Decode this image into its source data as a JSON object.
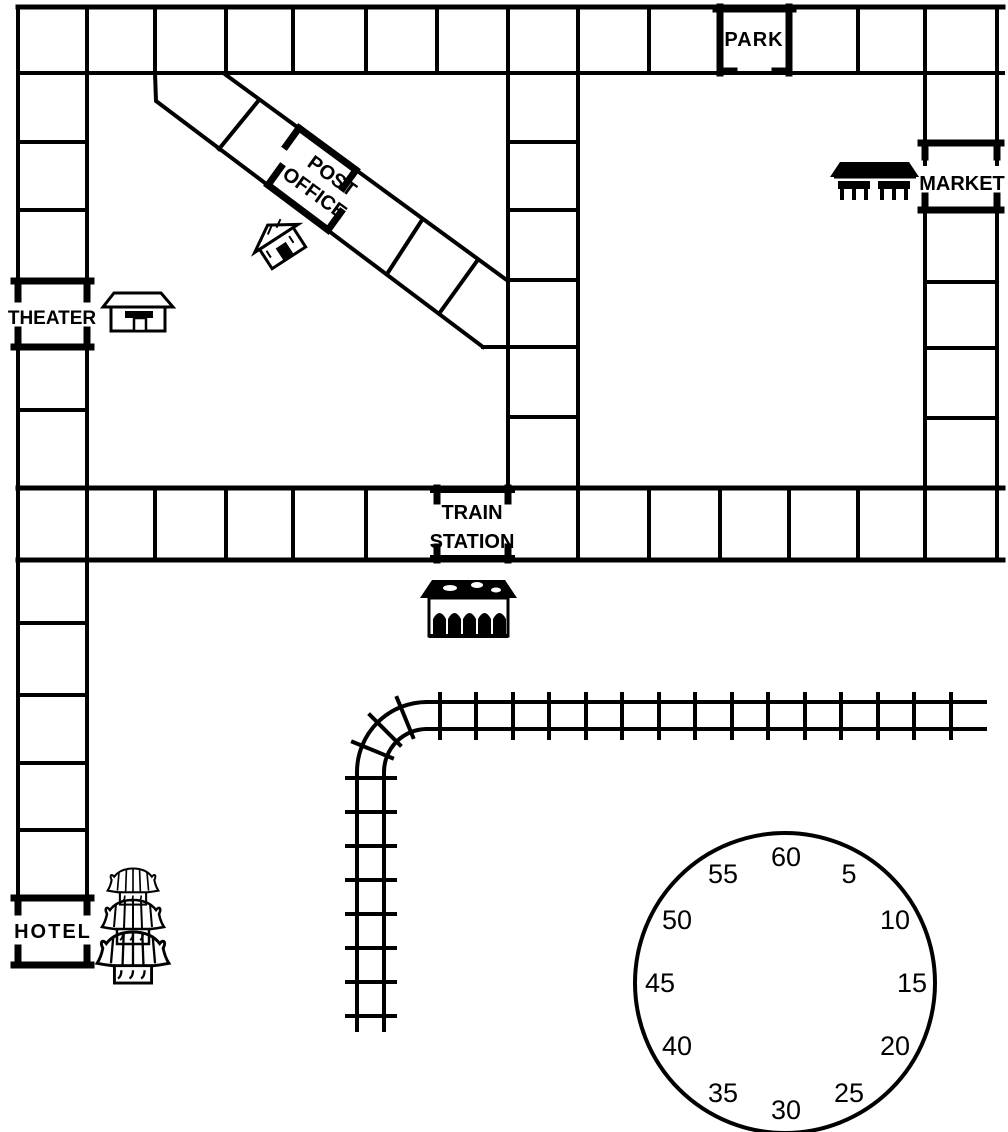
{
  "board": {
    "labels": {
      "park": "PARK",
      "post_office_line1": "POST",
      "post_office_line2": "OFFICE",
      "theater": "THEATER",
      "market": "MARKET",
      "train_station_line1": "TRAIN",
      "train_station_line2": "STATION",
      "hotel": "HOTEL"
    }
  },
  "clock": {
    "numbers": [
      "60",
      "5",
      "10",
      "15",
      "20",
      "25",
      "30",
      "35",
      "40",
      "45",
      "50",
      "55"
    ]
  },
  "icons": {
    "theater": "theater-building-icon",
    "post_office": "post-office-house-icon",
    "market": "market-stall-icon",
    "train_station": "train-station-building-icon",
    "hotel": "pagoda-hotel-icon",
    "railroad": "railroad-track",
    "timer": "minute-timer-dial"
  },
  "colors": {
    "ink": "#000000",
    "paper": "#ffffff"
  }
}
